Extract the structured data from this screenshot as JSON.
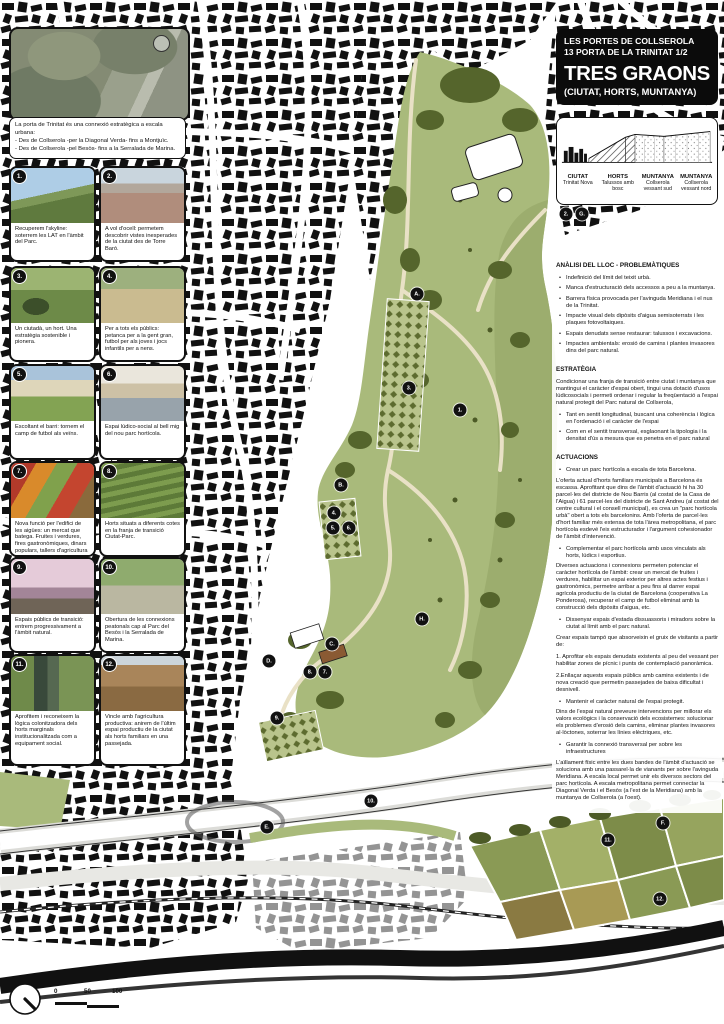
{
  "title_block": {
    "line1": "LES PORTES DE COLLSEROLA",
    "line2": "13 PORTA DE LA TRINITAT 1/2",
    "title": "TRES GRAONS",
    "subtitle": "(CIUTAT, HORTS, MUNTANYA)"
  },
  "intro": {
    "lines": [
      "La porta de Trinitat és una connexió estratègica a escala urbana:",
      "- Des de Collserola -per la Diagonal Verda- fins a Montjuïc.",
      "- Des de Collserola -pel Besòs- fins a la Serralada de Marina."
    ]
  },
  "section_legend": {
    "columns": [
      {
        "title": "CIUTAT",
        "sub": "Trinitat Nova"
      },
      {
        "title": "HORTS",
        "sub": "Talussos amb bosc"
      },
      {
        "title": "MUNTANYA",
        "sub": "Collserola vessant sud"
      },
      {
        "title": "MUNTANYA",
        "sub": "Collserola vessant nord"
      }
    ]
  },
  "photos": [
    {
      "num": "1.",
      "subject": "hillside-with-power-lines",
      "caption": "Recuperem l'skyline: soterrem les LAT en l'àmbit del Parc."
    },
    {
      "num": "2.",
      "subject": "city-panorama-from-torre-baro",
      "caption": "A vol d'ocell: permetem descobrir vistes inesperades de la ciutat des de Torre Baró."
    },
    {
      "num": "3.",
      "subject": "people-in-community-garden",
      "caption": "Un ciutadà, un hort. Una estratègia sostenible i pionera."
    },
    {
      "num": "4.",
      "subject": "people-walking-on-path",
      "caption": "Per a tots els públics: petanca per a la gent gran, futbol per als joves i jocs infantils per a nens."
    },
    {
      "num": "5.",
      "subject": "football-field-pavilion",
      "caption": "Escoltant el barri: tornem el camp de futbol als veïns."
    },
    {
      "num": "6.",
      "subject": "social-terrace-pergola",
      "caption": "Espai lúdico-social al bell mig del nou parc hortícola."
    },
    {
      "num": "7.",
      "subject": "market-produce-stalls",
      "caption": "Nova funció per l'edifici de les aigües: un mercat que batega. Fruites i verdures, fires gastronòmiques, dinars populars, tallers d'agricultura ecològica..."
    },
    {
      "num": "8.",
      "subject": "terraced-allotment-gardens",
      "caption": "Horts situats a diferents cotes en la franja de transició Ciutat-Parc."
    },
    {
      "num": "9.",
      "subject": "blossoming-trees-promenade",
      "caption": "Espais públics de transició: entrem progressivament a l'àmbit natural."
    },
    {
      "num": "10.",
      "subject": "park-path-with-fence",
      "caption": "Obertura de les connexions peatonals cap al Parc del Besòs i la Serralada de Marina."
    },
    {
      "num": "11.",
      "subject": "irrigation-canal",
      "caption": "Aprofitem i reconeixem la lògica colonitzadora dels horts marginals institucionalitzada com a equipament social."
    },
    {
      "num": "12.",
      "subject": "ploughed-agricultural-field",
      "caption": "Vincle amb l'agricultura productiva: anirem de l'últim espai productiu de la ciutat als horts familiars en una passejada."
    }
  ],
  "analysis": {
    "title": "ANÀLISI DEL LLOC - PROBLEMÀTIQUES",
    "bullets": [
      "Indefinició del límit del teixit urbà.",
      "Manca d'estructuració dels accessos a peu a la muntanya.",
      "Barrera física provocada per l'avinguda Meridiana i el nus de la Trinitat.",
      "Impacte visual dels dipòsits d'aigua semisoterrats i les plaques fotovoltaiques.",
      "Espais denudats sense restaurar: talussos i excavacions.",
      "Impactes ambientals: erosió de camins i plantes invasores dins del parc natural."
    ]
  },
  "strategy": {
    "title": "ESTRATÈGIA",
    "intro": "Condicionar una franja de transició entre ciutat i muntanya que mantingui el caràcter d'espai obert, tingui una dotació d'usos lúdicosocials i permeti ordenar i regular la freqüentació a l'espai natural protegit del Parc natural de Collserola,",
    "bullets": [
      "Tant en sentit longitudinal, buscant una coherència i lògica en l'ordenació i el caràcter de l'espai",
      "Com en el sentit transversal, esglaonant la tipologia i la densitat d'ús a mesura que es penetra en el parc natural"
    ]
  },
  "actions": {
    "title": "ACTUACIONS",
    "items": [
      {
        "type": "bullet",
        "text": "Crear un parc hortícola a escala de tota Barcelona."
      },
      {
        "type": "para",
        "text": "L'oferta actual d'horts familiars municipals a Barcelona és escassa. Aprofitant que dins de l'àmbit d'actuació hi ha 30 parcel·les del districte de Nou Barris (al costat de la Casa de l'Aigua) i 61 parcel·les del districte de Sant Andreu (al costat del centre cultural i el consell municipal), es crea un \"parc hortícola urbà\" obert a tots els barcelonins. Amb l'oferta de parcel·les d'hort familiar més extensa de tota l'àrea metropolitana, el parc hortícola esdevé l'eix estructurador i l'argument cohesionador de l'àmbit d'intervenció."
      },
      {
        "type": "bullet",
        "text": "Complementar el parc hortícola amb usos vinculats als horts, lúdics i esportius."
      },
      {
        "type": "para",
        "text": "Diverses actuacions i connexions permeten potenciar el caràcter hortícola de l'àmbit: crear un mercat de fruites i verdures, habilitar un espai exterior per altres actes festius i gastronòmics, permetre arribar a peu fins al darrer espai agrícola productiu de la ciutat de Barcelona (cooperativa La Ponderosa), recuperar el camp de futbol eliminat amb la construcció dels dipòsits d'aigua, etc."
      },
      {
        "type": "bullet",
        "text": "Dissenyar espais d'estada dissuassoris i miradors sobre la ciutat al límit amb el parc natural."
      },
      {
        "type": "para",
        "text": "Crear espais tampó que absorveixin el gruix de visitants a partir de:"
      },
      {
        "type": "para",
        "text": "1. Aprofitar els espais denudats existents al peu del vessant per habilitar zones de pícnic i punts de contemplació panoràmica."
      },
      {
        "type": "para",
        "text": "2.Enllaçar aquests espais públics amb camins existents i de nova creació que permetin passejades de baixa dificultat i desnivell."
      },
      {
        "type": "bullet",
        "text": "Mantenir el caràcter natural de l'espai protegit."
      },
      {
        "type": "para",
        "text": "Dins de l'espai natural preveure intervencions per millorar els valors ecològics i la conservació dels ecosistemes: solucionar els problemes d'erosió dels camins, eliminar plantes invasores al·lòctones, soterrar les línies elèctriques, etc."
      },
      {
        "type": "bullet",
        "text": "Garantir la connexió transversal per sobre les infraestructures"
      },
      {
        "type": "para",
        "text": "L'aïllament físic entre les dues bandes de l'àmbit d'actuació se soluciona amb una passarel·la de vianants per sobre l'avinguda Meridiana. A escala local permet unir els diversos sectors del parc hortícola. A escala metropolitana permet connectar la Diagonal Verda i el Besòs (a l'est de la Meridiana) amb la muntanya de Collserola (a l'oest)."
      }
    ]
  },
  "map": {
    "colors": {
      "park_green": "#a9ba7b",
      "dark_green": "#55652c",
      "path_beige": "#e9e1c6",
      "ink": "#111111"
    },
    "markers": [
      {
        "label": "1.",
        "x": 460,
        "y": 410
      },
      {
        "label": "2.",
        "x": 566,
        "y": 214
      },
      {
        "label": "3.",
        "x": 409,
        "y": 388
      },
      {
        "label": "4.",
        "x": 334,
        "y": 513
      },
      {
        "label": "5.",
        "x": 333,
        "y": 528
      },
      {
        "label": "6.",
        "x": 349,
        "y": 528
      },
      {
        "label": "7.",
        "x": 325,
        "y": 672
      },
      {
        "label": "8.",
        "x": 310,
        "y": 672
      },
      {
        "label": "9.",
        "x": 277,
        "y": 718
      },
      {
        "label": "10.",
        "x": 371,
        "y": 801
      },
      {
        "label": "11.",
        "x": 608,
        "y": 840
      },
      {
        "label": "12.",
        "x": 660,
        "y": 899
      },
      {
        "label": "A.",
        "x": 417,
        "y": 294
      },
      {
        "label": "B.",
        "x": 341,
        "y": 485
      },
      {
        "label": "C.",
        "x": 332,
        "y": 644
      },
      {
        "label": "D.",
        "x": 269,
        "y": 661
      },
      {
        "label": "E.",
        "x": 267,
        "y": 827
      },
      {
        "label": "F.",
        "x": 663,
        "y": 823
      },
      {
        "label": "G.",
        "x": 582,
        "y": 214
      },
      {
        "label": "H.",
        "x": 422,
        "y": 619
      }
    ]
  },
  "scale_bar": {
    "labels": [
      "0",
      "50",
      "100"
    ]
  }
}
